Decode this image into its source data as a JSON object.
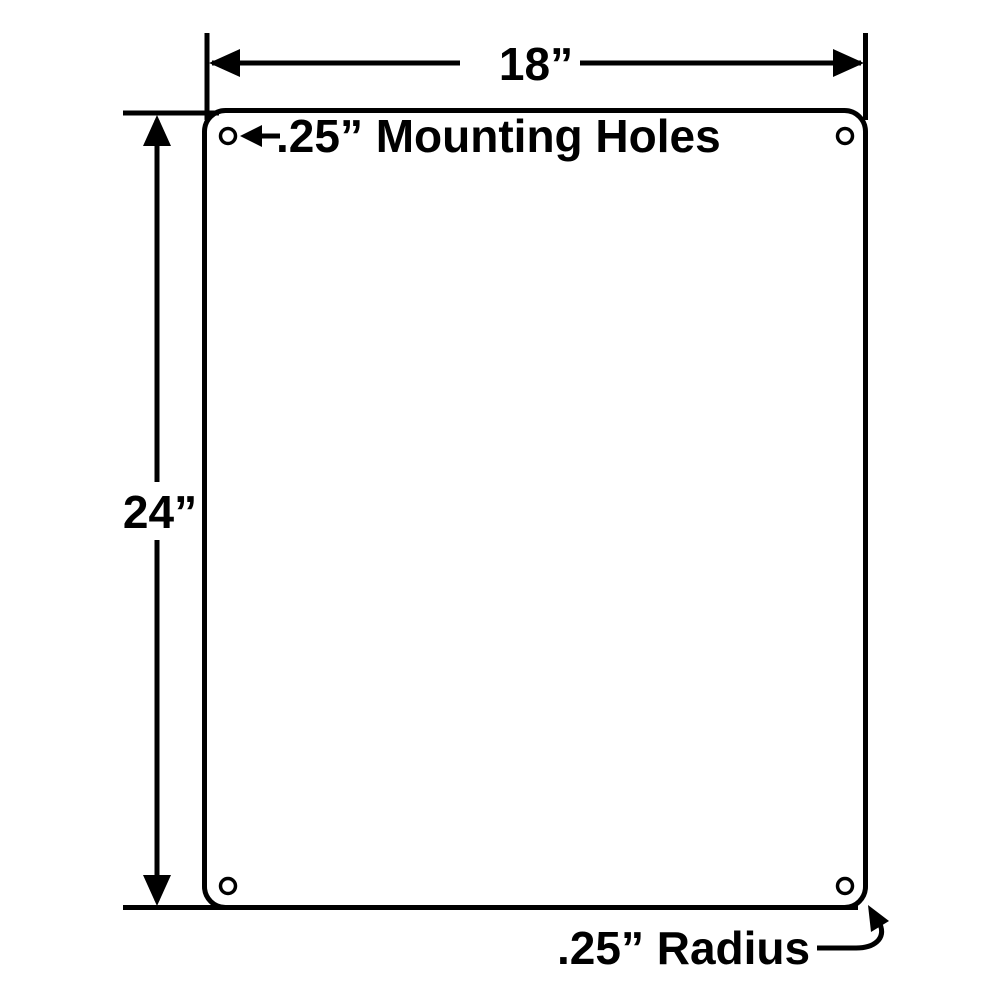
{
  "diagram": {
    "labels": {
      "width": "18”",
      "height": "24”",
      "mounting_holes": ".25” Mounting Holes",
      "corner_radius": ".25” Radius"
    },
    "values": {
      "panel_width_in": 18,
      "panel_height_in": 24,
      "mounting_hole_diameter_in": 0.25,
      "corner_radius_in": 0.25,
      "mounting_hole_count": 4
    },
    "colors": {
      "line": "#000000",
      "background": "#ffffff"
    }
  }
}
